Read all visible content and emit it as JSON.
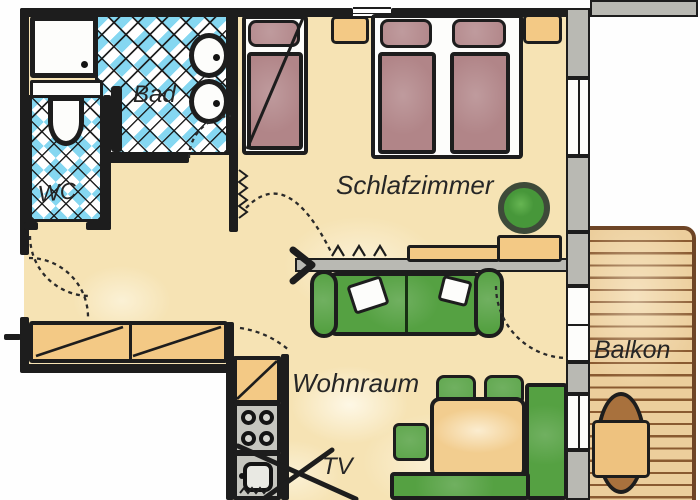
{
  "plan": {
    "type": "apartment-floor-plan",
    "rooms": {
      "bathroom": {
        "label": "Bad"
      },
      "wc": {
        "label": "WC"
      },
      "bedroom": {
        "label": "Schlafzimmer"
      },
      "living_room": {
        "label": "Wohnraum"
      },
      "balcony": {
        "label": "Balkon"
      }
    },
    "labels": {
      "tv": "TV"
    },
    "furniture": [
      "washing-machine",
      "toilet",
      "double-washbasin",
      "towel-radiator",
      "single-bed",
      "double-bed",
      "nightstand",
      "plant",
      "sideboard",
      "sofa",
      "dining-table",
      "chairs",
      "corner-bench",
      "tv-stand",
      "kitchen-counter",
      "stove",
      "kitchen-sink",
      "balcony-table"
    ],
    "palette": {
      "ink": "#1d1d1d",
      "floor_beige": "#f6e3b4",
      "tile_blue": "#85d7f1",
      "bed_mauve": "#b18588",
      "furniture_tan": "#f3c985",
      "furniture_green": "#55a142",
      "balcony_wood": "#ecce9c",
      "wood_line_brown": "#8a5a30",
      "wall_gray": "#b9b9b3",
      "table_brown": "#a8713d"
    }
  }
}
